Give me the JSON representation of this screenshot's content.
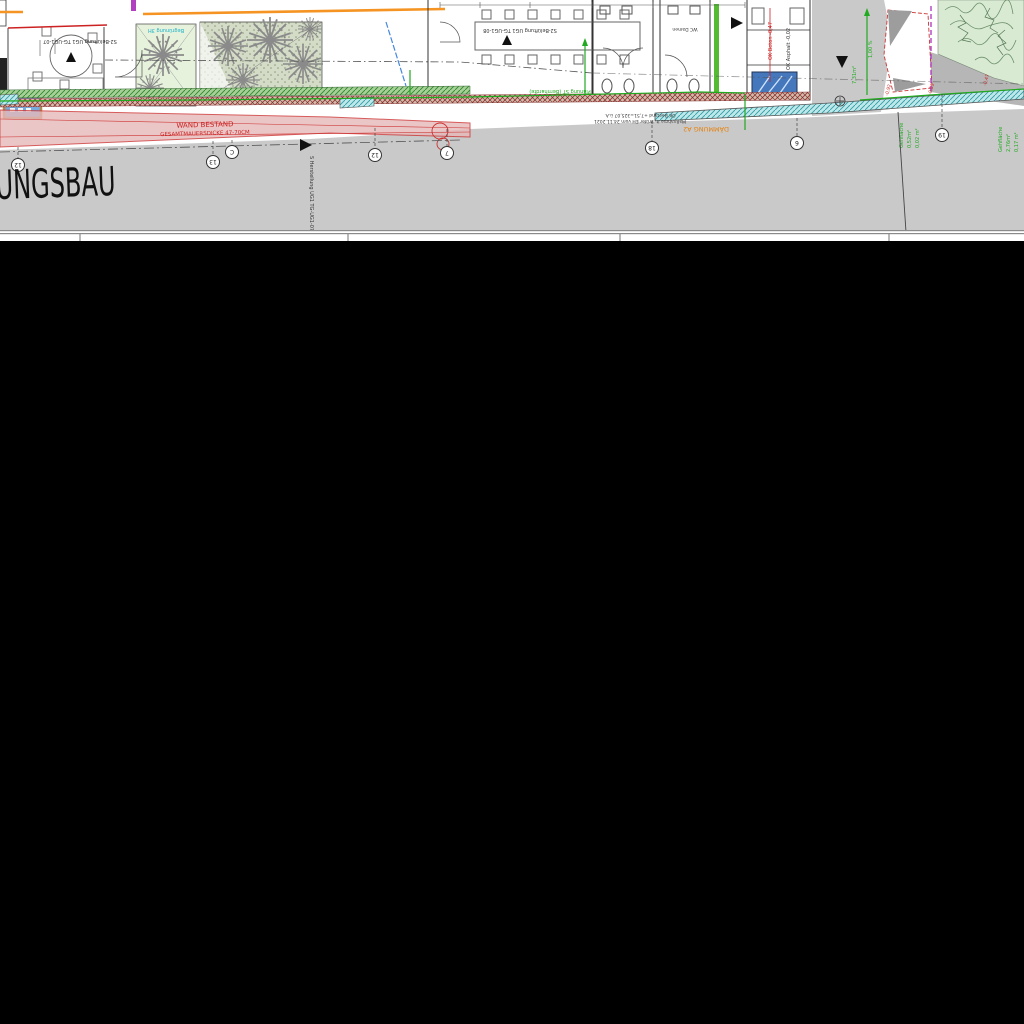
{
  "plan": {
    "big_label": "UNGSBAU",
    "wall_note": {
      "line1": "WAND BESTAND",
      "line2": "GESAMTMAUERSDICKE 47-70CM"
    },
    "insulation_note": "DÄMMUNG A2",
    "rooms": {
      "left_label": "S2-Belüftung UG1 TG-UG1-07",
      "mid_label": "S2-Belüftung UG1 TG-UG1-08",
      "wc_label": "WC Damen"
    },
    "shaft_label": "S Herstellung UG1 TG-UG1-07",
    "bestand_note": {
      "line1": "OK Bestand +7,51=325,07 ü.A.",
      "line2": "Maßnahme lt. Prüfer EH vom 24.11.2021"
    },
    "levels": {
      "ok_beton": "OK Beton -0,47",
      "ok_asphalt": "OK Asphalt -0,02",
      "l1": "-0,92",
      "l2": "-0,55",
      "l3": "-0,47"
    },
    "green_notes": {
      "garden": "Begrünung 3H",
      "boundary": "Planung ST (Bernhardte)",
      "slope": "1,00 %",
      "area": "7,31m²",
      "walk1": {
        "name": "Gehfläche",
        "a": "0,52m²",
        "b": "0,02 m²"
      },
      "walk2": {
        "name": "Gehfläche",
        "a": "2,76m²",
        "b": "0,17 m²"
      }
    },
    "grid_bubbles": [
      "12",
      "13",
      "C",
      "12",
      "7",
      "18",
      "6",
      "19"
    ],
    "colors": {
      "orange": "#f59422",
      "red": "#cc2222",
      "green": "#1faa1f",
      "teal": "#2f9ea8",
      "pink_band": "#e7b9b9",
      "ground_gray": "#c9c9c9",
      "paper": "#ffffff"
    }
  }
}
